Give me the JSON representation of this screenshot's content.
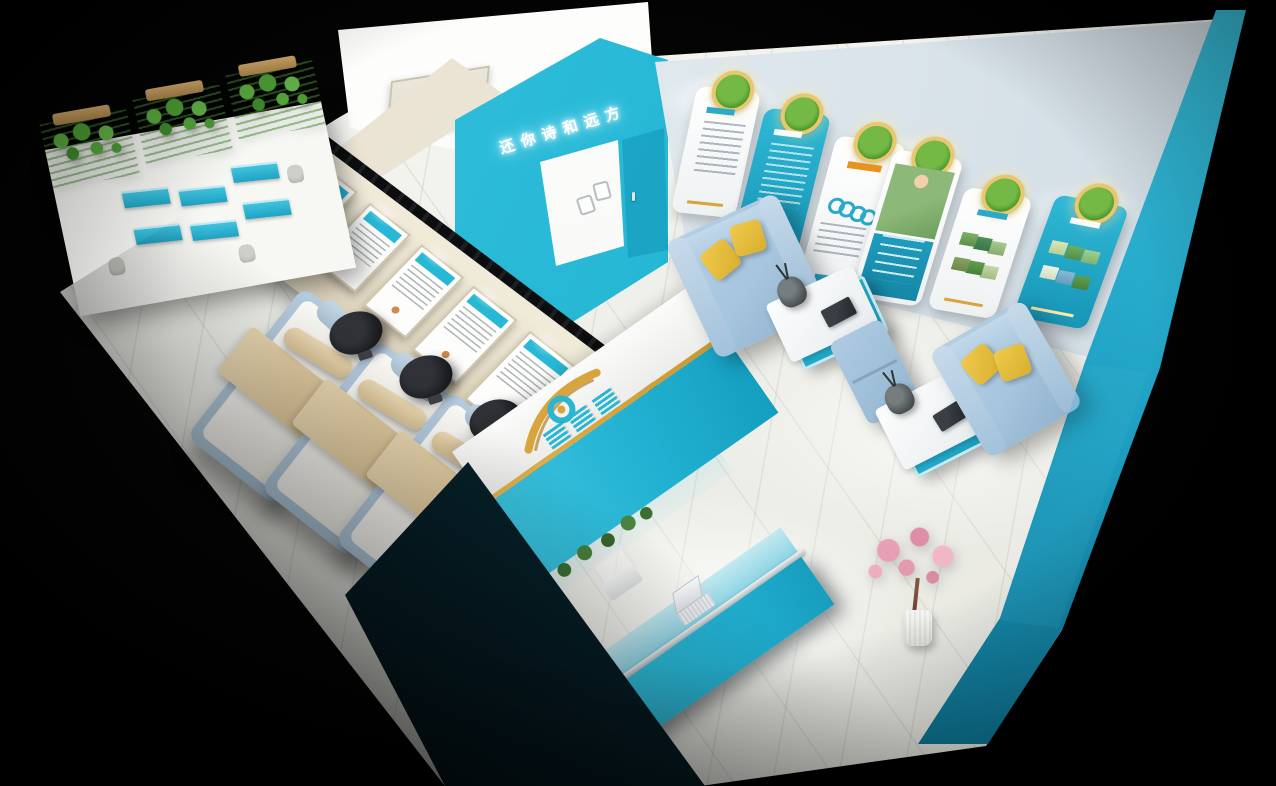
{
  "sign": {
    "text": "还你诗和远方"
  },
  "brand": {
    "logo_icon": "eye-swoosh-logo"
  },
  "palette": {
    "teal": "#27b8d6",
    "teal-dark": "#0e7d9e",
    "teal-deep": "#07506b",
    "teal-ink": "#0d3440",
    "cream": "#e9e2d0",
    "back-wall": "#e3eaf0",
    "floor": "#f3f3ef",
    "sofa-blue": "#a6c5de",
    "pillow-yellow": "#e8c23c",
    "gold": "#d9a43b",
    "medallion-green": "#57a234",
    "plant-green": "#4e9c3f",
    "bed-beige": "#e2cda4",
    "stool-black": "#1a1b1e",
    "blossom-pink": "#e79cb2"
  },
  "right_wall_posters": [
    {
      "variant": "white",
      "feature": "text"
    },
    {
      "variant": "teal",
      "feature": "text"
    },
    {
      "variant": "white",
      "feature": "rings"
    },
    {
      "variant": "white",
      "feature": "photo-boy"
    },
    {
      "variant": "white",
      "feature": "photo-grid"
    },
    {
      "variant": "teal",
      "feature": "photo-grid"
    }
  ],
  "left_wall_posters": [
    {
      "variant": "framed"
    },
    {
      "variant": "framed"
    },
    {
      "variant": "framed"
    },
    {
      "variant": "framed"
    },
    {
      "variant": "framed"
    },
    {
      "variant": "framed"
    }
  ]
}
